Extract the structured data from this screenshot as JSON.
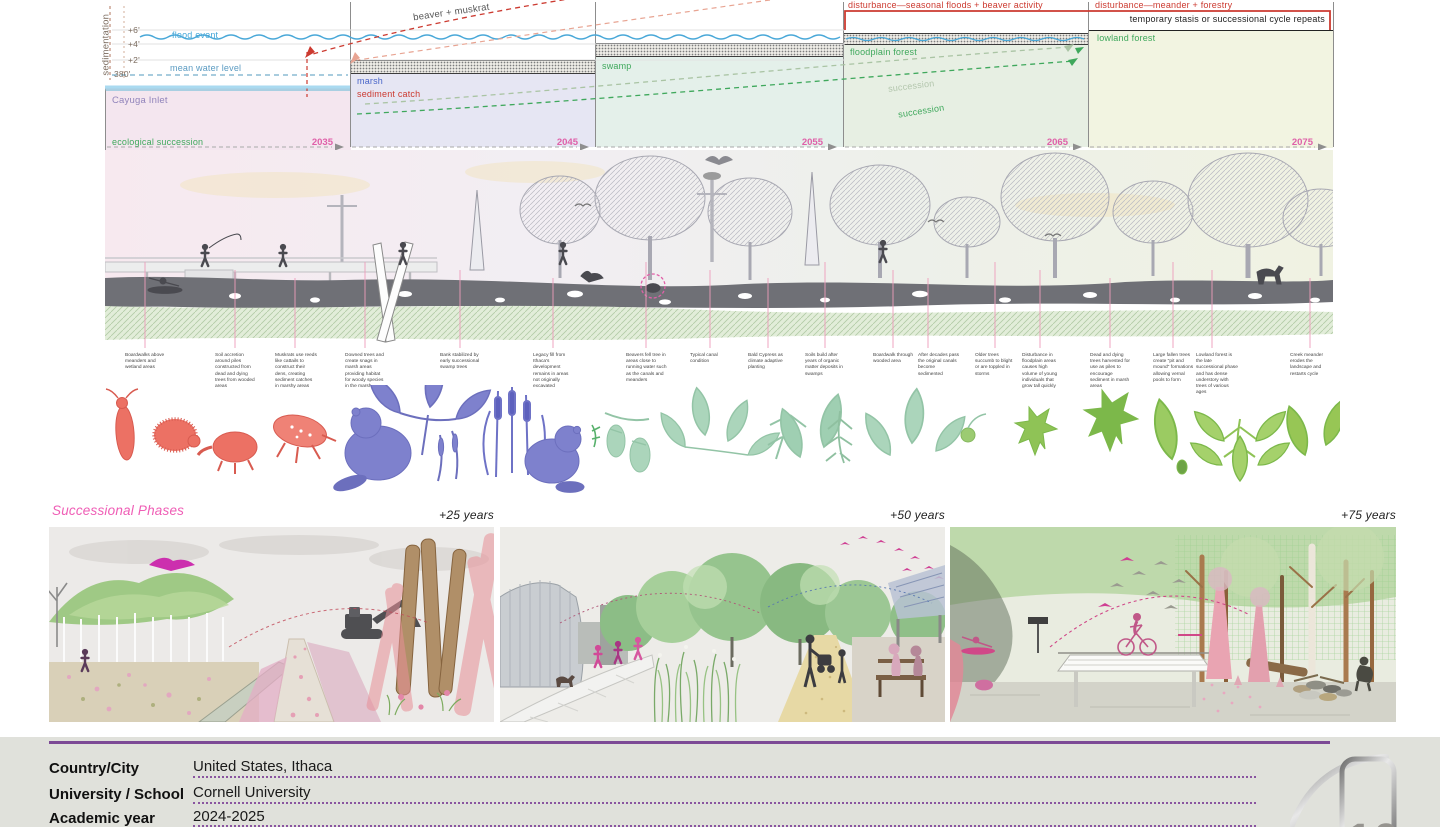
{
  "diagram": {
    "axis_label": "sedimentation",
    "ticks": [
      "+6'",
      "+4'",
      "+2'",
      "380'"
    ],
    "scale_note": "1/4\" = 1'-0\"",
    "flood_event": "flood event",
    "mean_water": "mean water level",
    "arrow_label": "beaver + muskrat",
    "timeline_label": "ecological succession",
    "sediment_catch": "sediment catch",
    "succession_label_1": "succession",
    "succession_label_2": "succession",
    "disturbance_1": "disturbance—seasonal floods + beaver activity",
    "disturbance_2": "disturbance—meander + forestry",
    "stasis": "temporary stasis or successional cycle repeats",
    "phases": [
      {
        "name": "Cayuga Inlet",
        "year": "2035"
      },
      {
        "name": "marsh",
        "year": "2045"
      },
      {
        "name": "swamp",
        "year": "2055"
      },
      {
        "name": "floodplain forest",
        "year": "2065"
      },
      {
        "name": "lowland forest",
        "year": "2075"
      }
    ],
    "colors": {
      "disturbance_red": "#cc3a30",
      "phase_pink": "#df5fa8",
      "label_green": "#3fa85c",
      "marsh_blue": "#4a66c9",
      "water_blue": "#45a7d8"
    }
  },
  "annotations": [
    {
      "text": "Boardwalks above meanders and wetland areas"
    },
    {
      "text": "Soil accretion around piles constructed from dead and dying trees from wooded areas"
    },
    {
      "text": "Muskrats use reeds like cattails to construct their dens, creating sediment catches in marshy areas"
    },
    {
      "text": "Downed trees and create snags in marsh areas providing habitat for woody species in the marsh"
    },
    {
      "text": "Bank stabilized by early successional swamp trees"
    },
    {
      "text": "Legacy fill from Ithaca's development remains in areas not originally excavated"
    },
    {
      "text": "Beavers fell tree in areas close to running water such as the canals and meanders"
    },
    {
      "text": "Typical canal condition"
    },
    {
      "text": "Bald Cypress as climate adaptive planting"
    },
    {
      "text": "Soils build after years of organic matter deposits in swamps"
    },
    {
      "text": "Boardwalk through wooded area"
    },
    {
      "text": "After decades pass the original canals become sedimented"
    },
    {
      "text": "Older trees succumb to blight or are toppled in storms"
    },
    {
      "text": "Disturbance in floodplain areas causes high volume of young individuals that grow tall quickly"
    },
    {
      "text": "Dead and dying trees harvested for use as piles to encourage sediment in marsh areas"
    },
    {
      "text": "Large fallen trees create \"pit and mound\" formations allowing vernal pools to form"
    },
    {
      "text": "Lowland forest is the late successional phase and has dense understory with trees of various ages"
    },
    {
      "text": "Creek meander erodes the landscape and restarts cycle"
    }
  ],
  "successional": {
    "title": "Successional Phases",
    "panel_labels": [
      "+25 years",
      "+50 years",
      "+75 years"
    ]
  },
  "footer": {
    "rows": [
      {
        "label": "Country/City",
        "value": "United States, Ithaca"
      },
      {
        "label": "University / School",
        "value": "Cornell University"
      },
      {
        "label": "Academic year",
        "value": "2024-2025"
      }
    ],
    "logo_number": "10",
    "accent": "#7d4a96"
  }
}
